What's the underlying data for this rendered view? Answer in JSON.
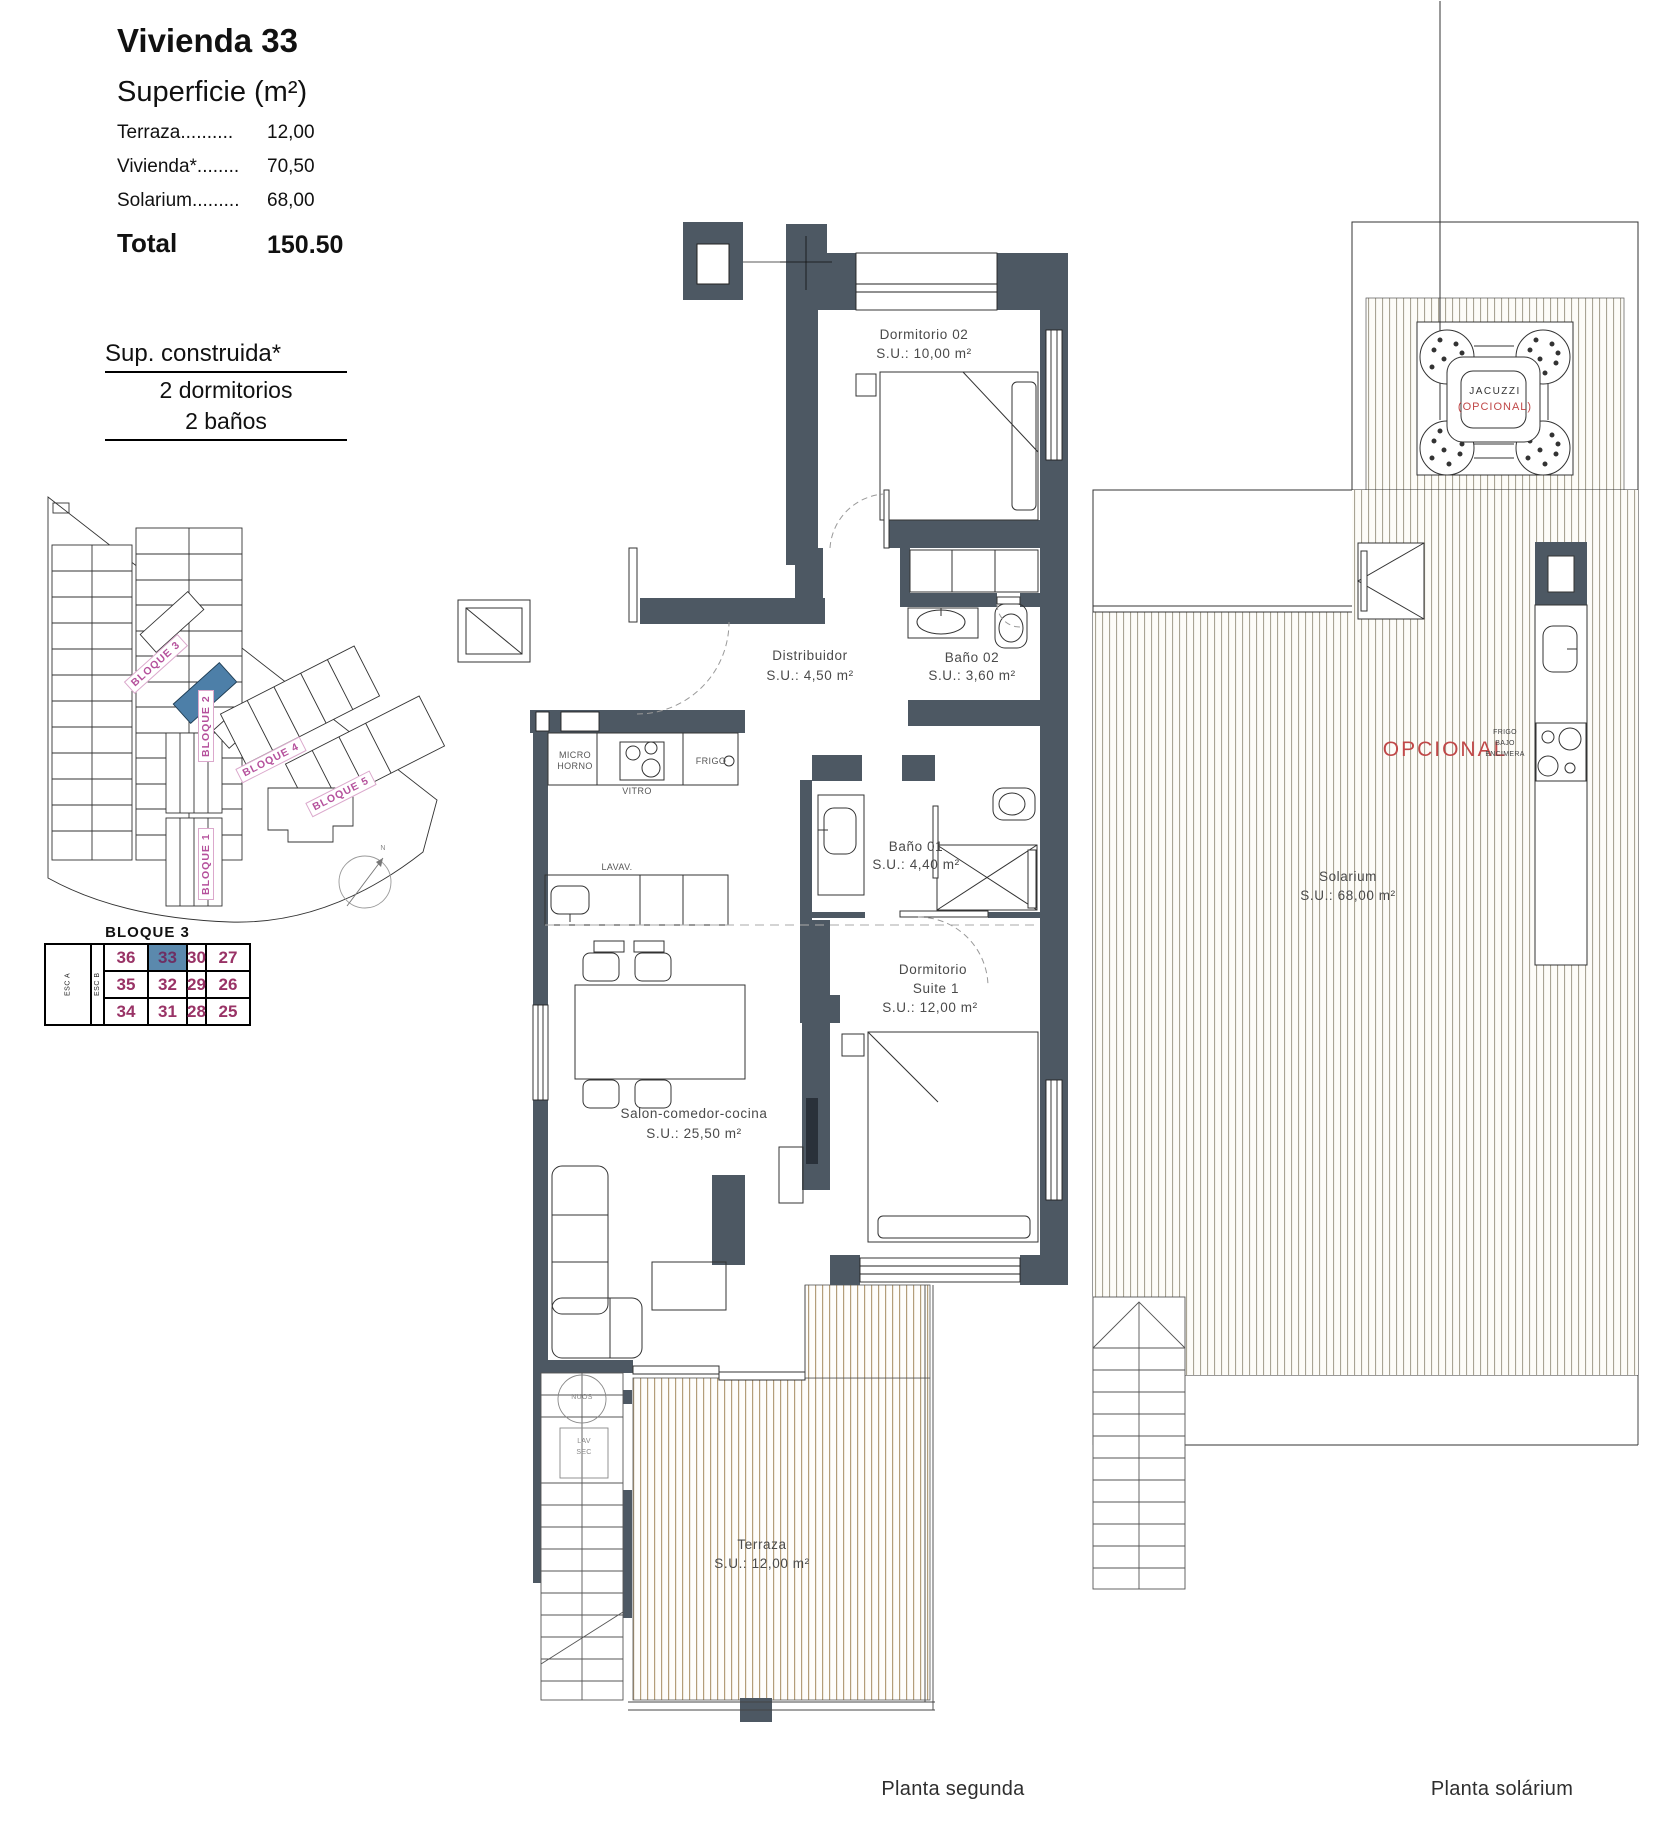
{
  "summary": {
    "title": "Vivienda 33",
    "subtitle": "Superficie (m²)",
    "rows": [
      {
        "label": "Terraza..........",
        "value": "12,00"
      },
      {
        "label": "Vivienda*........",
        "value": "70,50"
      },
      {
        "label": "Solarium.........",
        "value": "68,00"
      }
    ],
    "total_label": "Total",
    "total_value": "150.50"
  },
  "built_info": {
    "line1": "Sup. construida*",
    "line2": "2 dormitorios",
    "line3": "2 baños"
  },
  "site_plan": {
    "block_labels": {
      "b1": "BLOQUE 1",
      "b2": "BLOQUE 2",
      "b3": "BLOQUE 3",
      "b4": "BLOQUE 4",
      "b5": "BLOQUE 5"
    },
    "north": "N"
  },
  "block_table": {
    "title": "BLOQUE 3",
    "stair_a": "ESC A",
    "stair_b": "ESC B",
    "rows": [
      [
        "36",
        "33",
        "30",
        "27"
      ],
      [
        "35",
        "32",
        "29",
        "26"
      ],
      [
        "34",
        "31",
        "28",
        "25"
      ]
    ],
    "highlighted_unit": "33"
  },
  "second_floor": {
    "caption": "Planta segunda",
    "rooms": {
      "dormitorio02": {
        "name": "Dormitorio 02",
        "area": "S.U.: 10,00 m²"
      },
      "distribuidor": {
        "name": "Distribuidor",
        "area": "S.U.: 4,50 m²"
      },
      "bano02": {
        "name": "Baño 02",
        "area": "S.U.: 3,60 m²"
      },
      "bano01": {
        "name": "Baño 01",
        "area": "S.U.: 4,40 m²"
      },
      "suite": {
        "name": "Dormitorio",
        "name2": "Suite 1",
        "area": "S.U.: 12,00 m²"
      },
      "salon": {
        "name": "Salon-comedor-cocina",
        "area": "S.U.: 25,50 m²"
      },
      "terraza": {
        "name": "Terraza",
        "area": "S.U.: 12,00 m²"
      }
    },
    "appliances": {
      "micro": "MICRO",
      "horno": "HORNO",
      "vitro": "VITRO",
      "frigo": "FRIGO",
      "lavavajillas": "LAVAV.",
      "water_heater": "NUOS",
      "washer": "LAV",
      "dryer": "SEC"
    }
  },
  "solarium_floor": {
    "caption": "Planta solárium",
    "room": {
      "name": "Solarium",
      "area": "S.U.: 68,00 m²"
    },
    "jacuzzi": {
      "label": "JACUZZI",
      "optional": "(OPCIONAL)"
    },
    "optional_label": "OPCIONAL",
    "kitchenette": {
      "line1": "FRIGO",
      "line2": "BAJO",
      "line3": "ENCIMERA"
    }
  },
  "colors": {
    "wall": "#4d5863",
    "highlight_unit": "#4d7fa8",
    "unit_number": "#993366",
    "block_label": "#b5519c",
    "optional_red": "#c04848",
    "deck_terraza": "#b39d79",
    "deck_solarium": "#a9a494"
  }
}
